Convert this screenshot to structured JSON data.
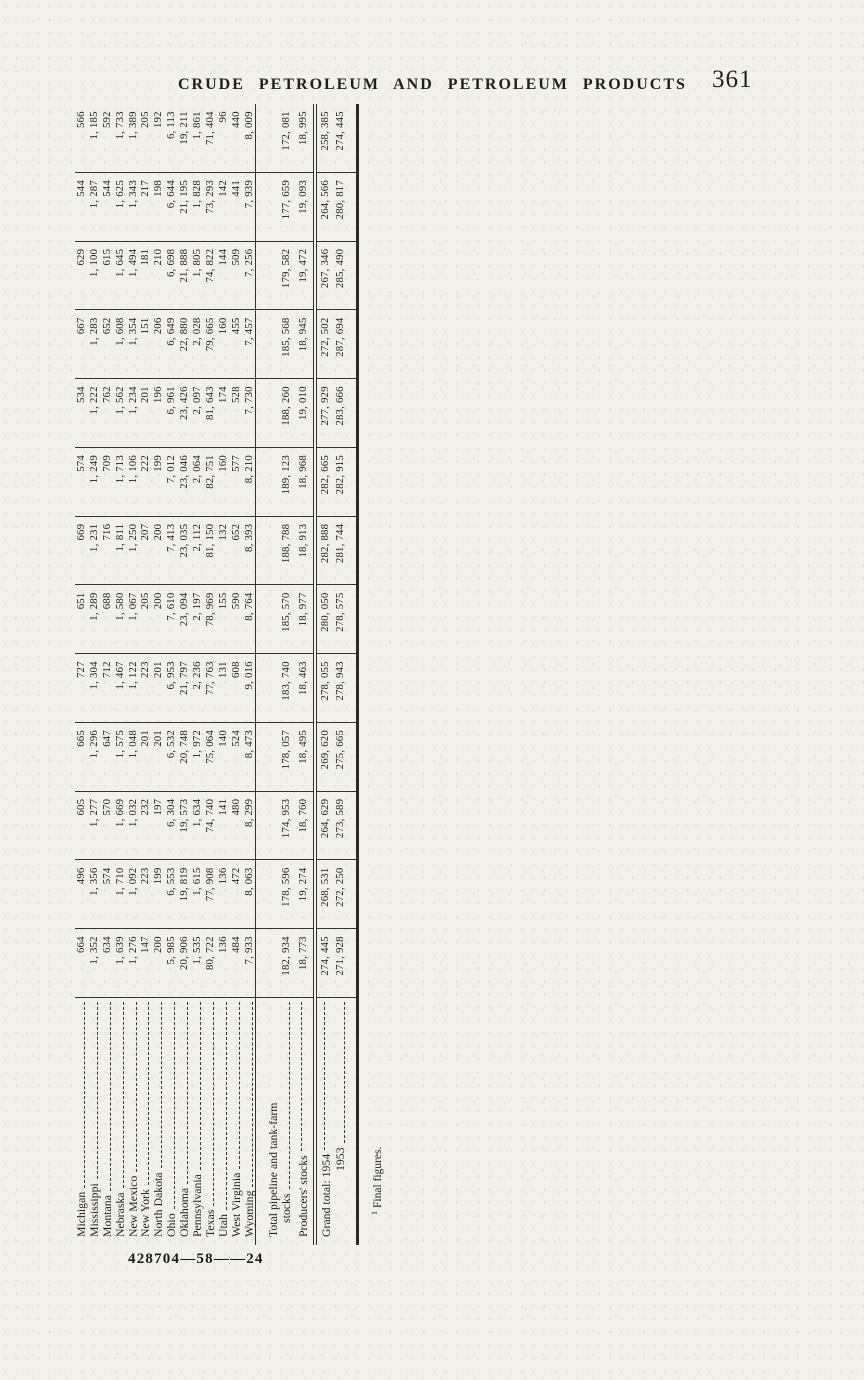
{
  "page_header": {
    "title": "CRUDE PETROLEUM AND PETROLEUM PRODUCTS",
    "page_number": "361"
  },
  "signature_mark": "428704—58——24",
  "footnote": {
    "marker": "1",
    "text": "Final figures."
  },
  "table": {
    "state_rows": [
      {
        "label": "Michigan",
        "values": [
          "664",
          "496",
          "605",
          "665",
          "727",
          "651",
          "669",
          "574",
          "534",
          "667",
          "629",
          "544",
          "566"
        ]
      },
      {
        "label": "Mississippi",
        "values": [
          "1, 352",
          "1, 356",
          "1, 277",
          "1, 296",
          "1, 304",
          "1, 289",
          "1, 231",
          "1, 249",
          "1, 222",
          "1, 283",
          "1, 100",
          "1, 287",
          "1, 185"
        ]
      },
      {
        "label": "Montana",
        "values": [
          "634",
          "574",
          "570",
          "647",
          "712",
          "688",
          "716",
          "709",
          "762",
          "652",
          "615",
          "544",
          "592"
        ]
      },
      {
        "label": "Nebraska",
        "values": [
          "1, 639",
          "1, 710",
          "1, 669",
          "1, 575",
          "1, 467",
          "1, 580",
          "1, 811",
          "1, 713",
          "1, 562",
          "1, 608",
          "1, 645",
          "1, 625",
          "1, 733"
        ]
      },
      {
        "label": "New Mexico",
        "values": [
          "1, 276",
          "1, 092",
          "1, 032",
          "1, 048",
          "1, 122",
          "1, 067",
          "1, 250",
          "1, 106",
          "1, 234",
          "1, 354",
          "1, 494",
          "1, 343",
          "1, 389"
        ]
      },
      {
        "label": "New York",
        "values": [
          "147",
          "223",
          "232",
          "201",
          "223",
          "205",
          "207",
          "222",
          "201",
          "151",
          "181",
          "217",
          "205"
        ]
      },
      {
        "label": "North Dakota",
        "values": [
          "200",
          "199",
          "197",
          "201",
          "201",
          "200",
          "200",
          "199",
          "196",
          "206",
          "210",
          "198",
          "192"
        ]
      },
      {
        "label": "Ohio",
        "values": [
          "5, 985",
          "6, 553",
          "6, 304",
          "6, 532",
          "6, 953",
          "7, 610",
          "7, 413",
          "7, 012",
          "6, 961",
          "6, 649",
          "6, 698",
          "6, 644",
          "6, 113"
        ]
      },
      {
        "label": "Oklahoma",
        "values": [
          "20, 906",
          "19, 819",
          "19, 573",
          "20, 748",
          "21, 797",
          "23, 094",
          "23, 035",
          "23, 046",
          "23, 426",
          "22, 880",
          "21, 888",
          "21, 195",
          "19, 211"
        ]
      },
      {
        "label": "Pennsylvania",
        "values": [
          "1, 535",
          "1, 615",
          "1, 634",
          "1, 972",
          "2, 236",
          "2, 197",
          "2, 112",
          "2, 064",
          "2, 097",
          "2, 028",
          "1, 805",
          "1, 828",
          "1, 861"
        ]
      },
      {
        "label": "Texas",
        "values": [
          "80, 722",
          "77, 908",
          "74, 740",
          "75, 064",
          "77, 763",
          "78, 969",
          "81, 150",
          "82, 751",
          "81, 643",
          "79, 665",
          "74, 822",
          "73, 293",
          "71, 404"
        ]
      },
      {
        "label": "Utah",
        "values": [
          "136",
          "136",
          "141",
          "140",
          "131",
          "155",
          "132",
          "160",
          "174",
          "160",
          "144",
          "142",
          "96"
        ]
      },
      {
        "label": "West Virginia",
        "values": [
          "484",
          "472",
          "480",
          "524",
          "608",
          "590",
          "652",
          "577",
          "528",
          "455",
          "509",
          "441",
          "440"
        ]
      },
      {
        "label": "Wyoming",
        "values": [
          "7, 933",
          "8, 063",
          "8, 299",
          "8, 473",
          "9, 016",
          "8, 764",
          "8, 393",
          "8, 210",
          "7, 730",
          "7, 457",
          "7, 256",
          "7, 939",
          "8, 009"
        ]
      }
    ],
    "total_pipeline": {
      "label_line1": "Total pipeline and tank-farm",
      "label_line2": "stocks",
      "values": [
        "182, 934",
        "178, 596",
        "174, 953",
        "178, 057",
        "183, 740",
        "185, 570",
        "188, 788",
        "189, 123",
        "188, 260",
        "185, 568",
        "179, 582",
        "177, 659",
        "172, 081"
      ]
    },
    "producers": {
      "label": "Producers' stocks",
      "values": [
        "18, 773",
        "19, 274",
        "18, 760",
        "18, 495",
        "18, 463",
        "18, 977",
        "18, 913",
        "18, 968",
        "19, 010",
        "18, 945",
        "19, 472",
        "19, 093",
        "18, 995"
      ]
    },
    "grand_1954": {
      "label": "Grand total: 1954",
      "values": [
        "274, 445",
        "268, 531",
        "264, 629",
        "269, 620",
        "278, 055",
        "280, 050",
        "282, 888",
        "282, 665",
        "277, 929",
        "272, 502",
        "267, 346",
        "264, 566",
        "258, 385"
      ]
    },
    "grand_1953": {
      "label": "1953",
      "values": [
        "271, 928",
        "272, 250",
        "273, 589",
        "275, 665",
        "278, 943",
        "278, 575",
        "281, 744",
        "282, 915",
        "283, 666",
        "287, 694",
        "285, 490",
        "280, 817",
        "274, 445"
      ]
    }
  }
}
